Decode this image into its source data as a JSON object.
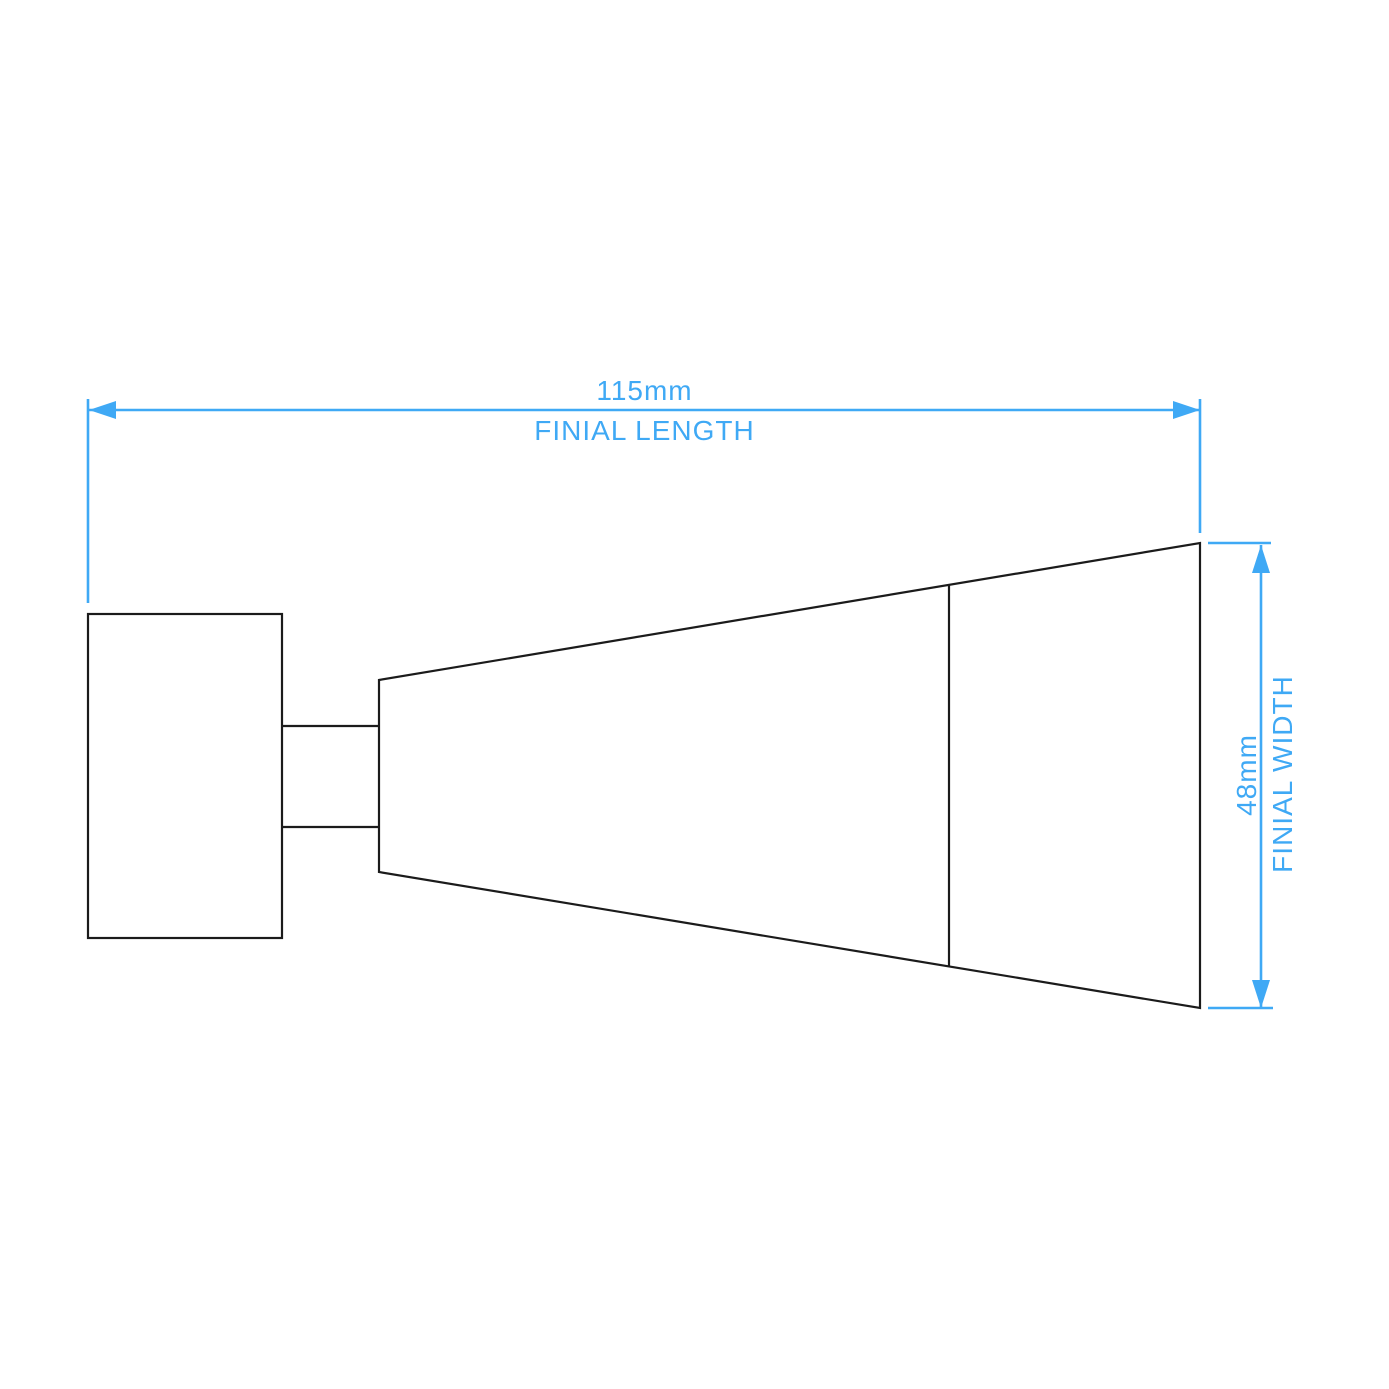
{
  "diagram": {
    "background_color": "#ffffff",
    "outline_color": "#1b1b1b",
    "dimension_color": "#3fa9f5",
    "length_dimension": {
      "value": "115mm",
      "label": "FINIAL LENGTH"
    },
    "width_dimension": {
      "value": "48mm",
      "label": "FINIAL WIDTH"
    }
  }
}
